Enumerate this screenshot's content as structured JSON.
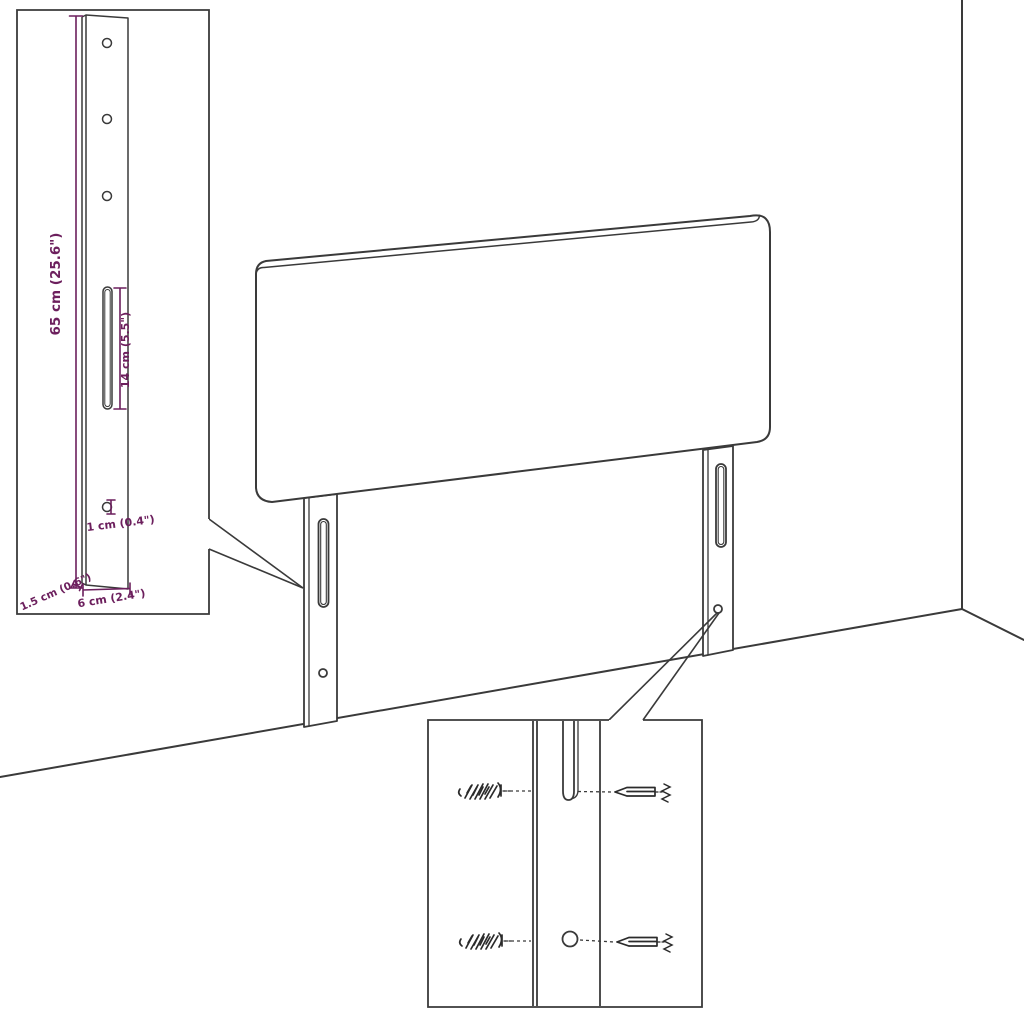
{
  "diagram": {
    "subject": "headboard-assembly-diagram",
    "dimensions": {
      "bracket_height": "65 cm (25.6\")",
      "slot_length": "14 cm (5.5\")",
      "hole_diameter": "1 cm (0.4\")",
      "bracket_depth": "1.5 cm (0.6\")",
      "bracket_width": "6 cm (2.4\")"
    },
    "colors": {
      "dimension": "#6c1f5d",
      "line": "#3a3a3a",
      "background": "#ffffff"
    }
  }
}
